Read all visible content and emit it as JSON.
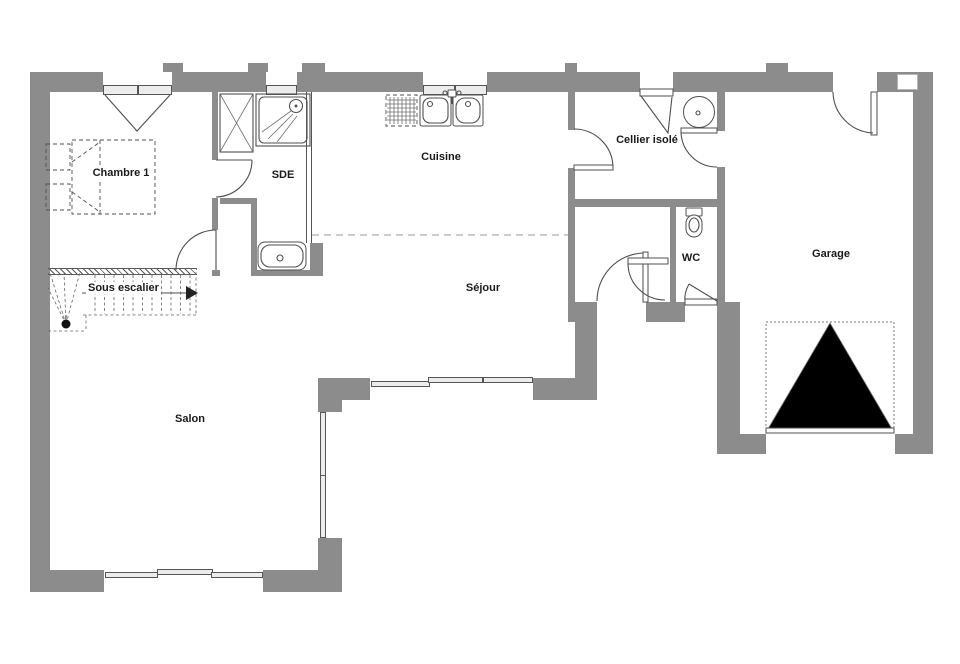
{
  "plan": {
    "rooms": [
      {
        "id": "chambre-1",
        "label": "Chambre 1"
      },
      {
        "id": "sde",
        "label": "SDE"
      },
      {
        "id": "cuisine",
        "label": "Cuisine"
      },
      {
        "id": "cellier",
        "label": "Cellier isolé"
      },
      {
        "id": "wc",
        "label": "WC"
      },
      {
        "id": "garage",
        "label": "Garage"
      },
      {
        "id": "sejour",
        "label": "Séjour"
      },
      {
        "id": "salon",
        "label": "Salon"
      }
    ],
    "stairs": {
      "label": "Sous escalier"
    },
    "colors": {
      "wall": "#8c8c8c",
      "line": "#4f4f4f",
      "dash": "#9a9a9a",
      "glass": "#ececec",
      "text": "#1a1a1a",
      "bg": "#ffffff"
    }
  }
}
